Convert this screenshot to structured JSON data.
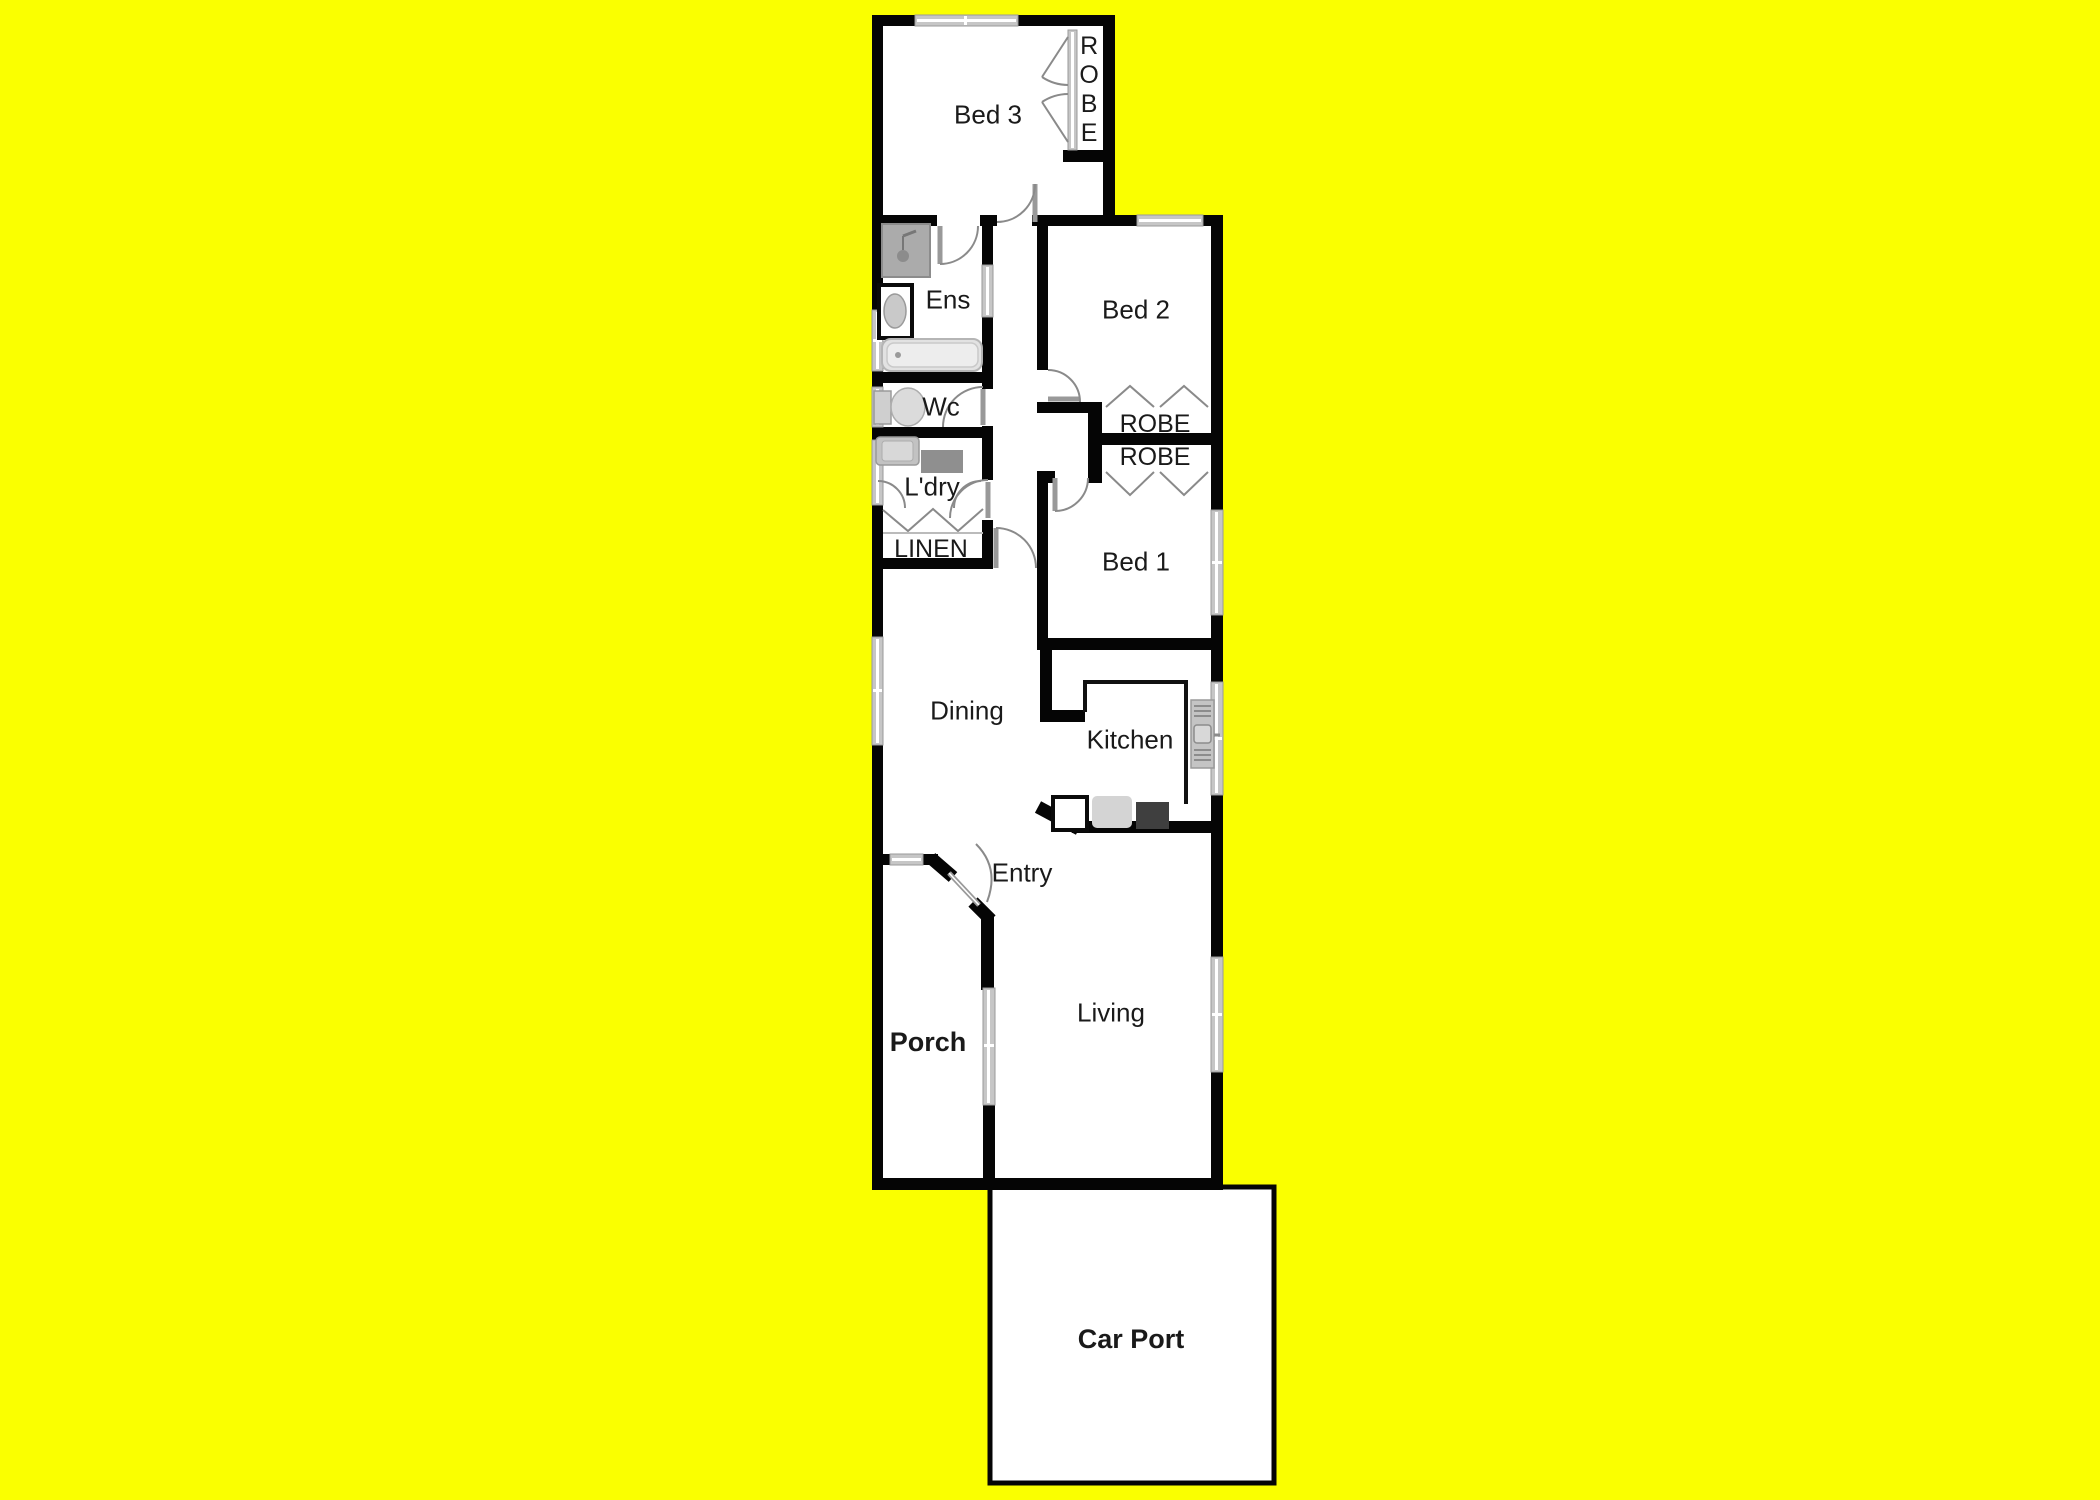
{
  "title": "Residential floor plan",
  "colors": {
    "bg": "#FAFF00",
    "wall": "#050505",
    "floor": "#FFFFFF",
    "glass": "#C6C6C6",
    "frame": "#9A9A9A",
    "arc": "#8A8A8A",
    "fix": "#BFBFBF",
    "fixdark": "#3F3F3F",
    "text": "#1A1A1A"
  },
  "rooms": {
    "bed3": {
      "label": "Bed 3"
    },
    "robe_bed3": {
      "label": "ROBE"
    },
    "ens": {
      "label": "Ens"
    },
    "bed2": {
      "label": "Bed 2"
    },
    "wc": {
      "label": "Wc"
    },
    "robe_bed2": {
      "label": "ROBE"
    },
    "robe_bed1": {
      "label": "ROBE"
    },
    "laundry": {
      "label": "L'dry"
    },
    "linen": {
      "label": "LINEN"
    },
    "bed1": {
      "label": "Bed 1"
    },
    "dining": {
      "label": "Dining"
    },
    "kitchen": {
      "label": "Kitchen"
    },
    "entry": {
      "label": "Entry"
    },
    "living": {
      "label": "Living"
    },
    "porch": {
      "label": "Porch"
    },
    "carport": {
      "label": "Car Port"
    }
  },
  "fixtures": [
    "shower-icon",
    "ensuite-toilet-icon",
    "bathtub-icon",
    "wc-toilet-icon",
    "laundry-trough-icon",
    "washing-machine-icon",
    "kitchen-sink-icon",
    "dishwasher-icon",
    "cooktop-icon",
    "fridge-icon"
  ]
}
